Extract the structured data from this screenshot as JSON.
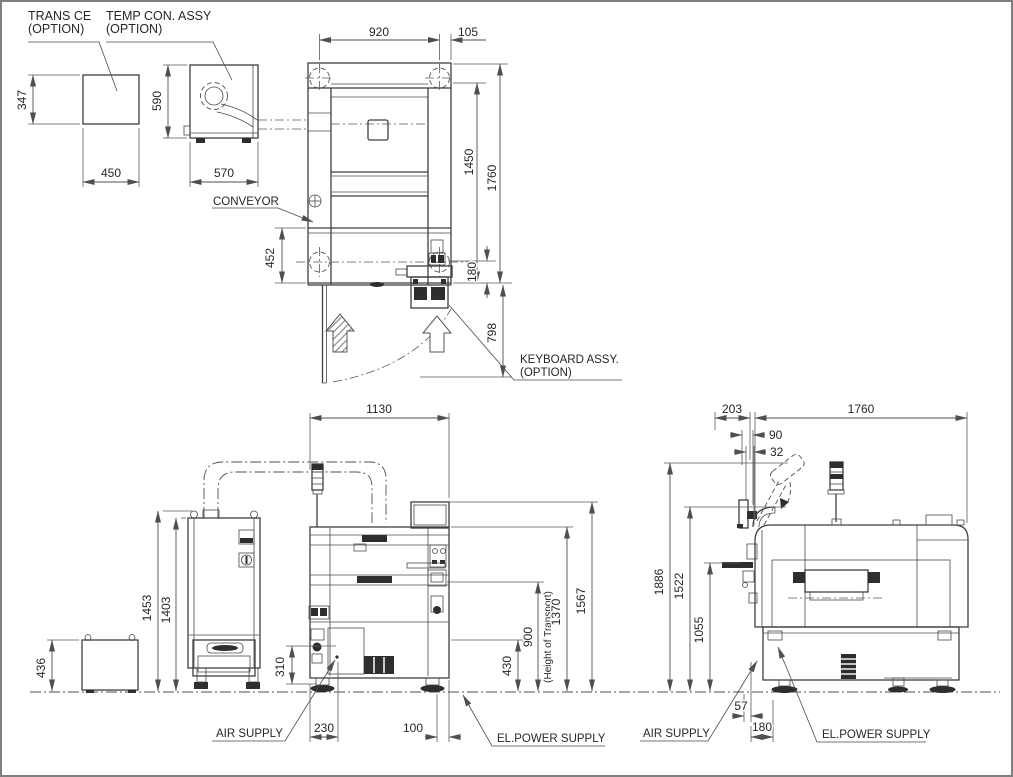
{
  "drawing": {
    "option_units": {
      "trans_ce": {
        "label_line1": "TRANS CE",
        "label_line2": "(OPTION)",
        "height": "347",
        "width": "450"
      },
      "temp_con": {
        "label_line1": "TEMP CON. ASSY",
        "label_line2": "(OPTION)",
        "height": "590",
        "width": "570"
      }
    },
    "top_view": {
      "conveyor_label": "CONVEYOR",
      "keyboard": {
        "label_line1": "KEYBOARD ASSY.",
        "label_line2": "(OPTION)"
      },
      "dims": {
        "rail_span": "920",
        "right_offset": "105",
        "depth_inner": "1450",
        "depth_total": "1760",
        "front_depth": "452",
        "rear_offset": "180",
        "door_swing": "798"
      }
    },
    "front_view": {
      "air_supply_label": "AIR SUPPLY",
      "power_label": "EL.POWER SUPPLY",
      "dims": {
        "width": "1130",
        "cabinet_height": "1453",
        "cabinet_inner_height": "1403",
        "box_height": "436",
        "air_height": "310",
        "air_offset": "230",
        "power_offset": "100",
        "base_height": "430",
        "transport_height": "900",
        "transport_note": "(Height of Transport)",
        "body_height": "1370",
        "total_height": "1567"
      }
    },
    "side_view": {
      "air_supply_label": "AIR SUPPLY",
      "power_label": "EL.POWER SUPPLY",
      "dims": {
        "monitor_offset": "203",
        "depth": "1760",
        "arm_offset": "90",
        "monitor_thickness": "32",
        "max_height": "1886",
        "monitor_height": "1522",
        "table_height": "1055",
        "air_offset": "57",
        "power_offset": "180"
      }
    }
  },
  "colors": {
    "line": "#474747",
    "dark_fill": "#2e2e2e",
    "text": "#262626",
    "background": "#ffffff",
    "border": "#7f7f7f"
  }
}
